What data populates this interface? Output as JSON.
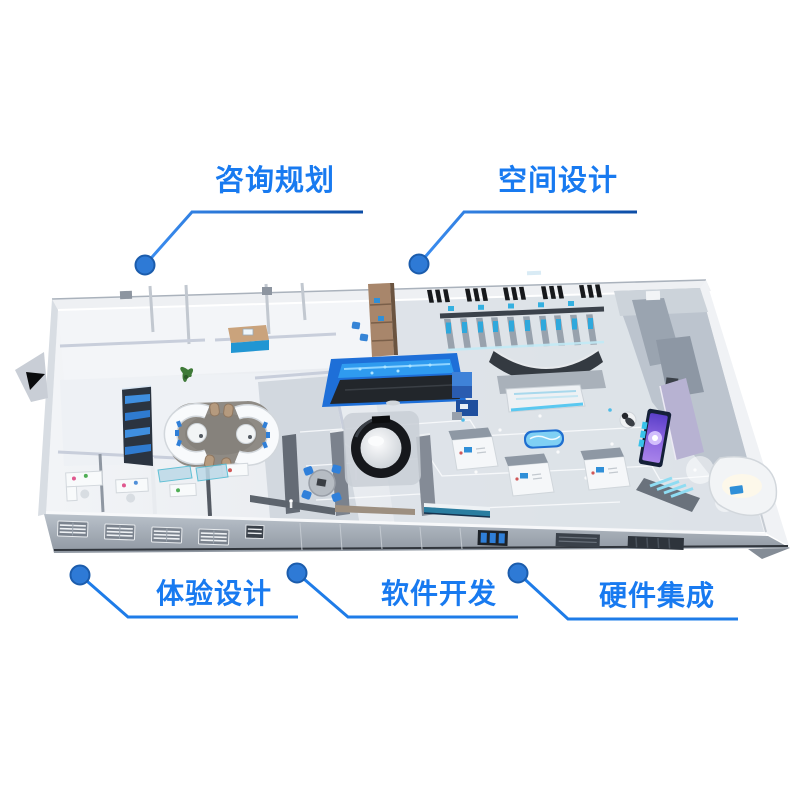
{
  "page": {
    "background": "#ffffff",
    "width": 800,
    "height": 800
  },
  "labels": {
    "consulting": "咨询规划",
    "space_design": "空间设计",
    "experience_design": "体验设计",
    "software_development": "软件开发",
    "hardware_integration": "硬件集成"
  },
  "icons": {
    "leader_dot": "●"
  },
  "palette": {
    "label_text": "#187af0",
    "leader_line": "#1e7ce8",
    "leader_line_dark": "#0c4da6",
    "leader_dot_fill": "#2e7ad6",
    "leader_dot_stroke": "#1b5cac",
    "accent_blue": "#2f7fd8",
    "glow_cyan": "#5ac8f0",
    "screen_purple": "#7a5ae0",
    "wood_tan": "#b08f6e",
    "wall_light": "#eef1f5",
    "floor_gray": "#d9dee5",
    "dark_panel": "#23262c"
  }
}
